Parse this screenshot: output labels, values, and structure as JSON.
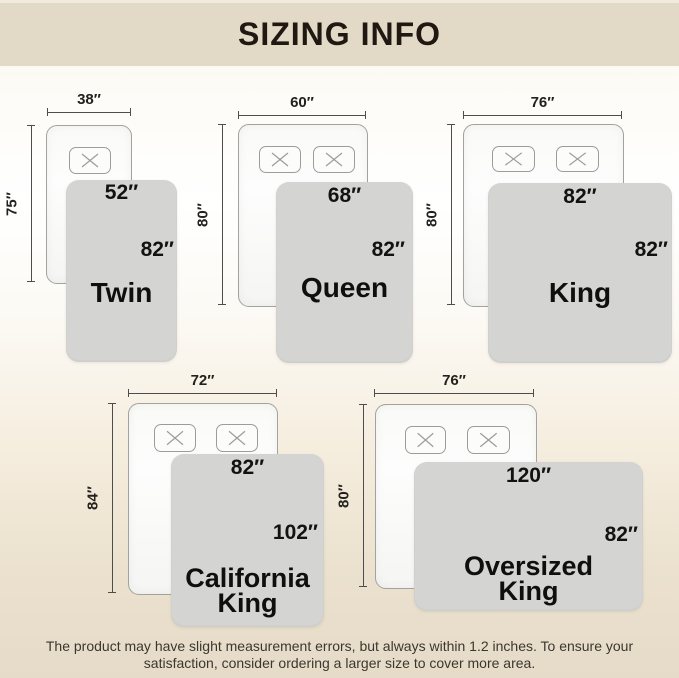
{
  "header": {
    "title": "SIZING INFO"
  },
  "diagrams": [
    {
      "name": "Twin",
      "bed_width": "38″",
      "bed_length": "75″",
      "blanket_width": "52″",
      "blanket_length": "82″",
      "pillow_count": 1
    },
    {
      "name": "Queen",
      "bed_width": "60″",
      "bed_length": "80″",
      "blanket_width": "68″",
      "blanket_length": "82″",
      "pillow_count": 2
    },
    {
      "name": "King",
      "bed_width": "76″",
      "bed_length": "80″",
      "blanket_width": "82″",
      "blanket_length": "82″",
      "pillow_count": 2
    },
    {
      "name": "California King",
      "bed_width": "72″",
      "bed_length": "84″",
      "blanket_width": "82″",
      "blanket_length": "102″",
      "pillow_count": 2
    },
    {
      "name": "Oversized King",
      "bed_width": "76″",
      "bed_length": "80″",
      "blanket_width": "120″",
      "blanket_length": "82″",
      "pillow_count": 2
    }
  ],
  "footer": {
    "line1": "The product may have slight measurement errors, but always within 1.2 inches. To ensure your",
    "line2": "satisfaction, consider ordering a larger size to cover more area."
  },
  "colors": {
    "banner": "#e3d9c7",
    "blanket": "#d4d4d3",
    "bed_border": "#a2a29e",
    "dimension_line": "#4d4d4d",
    "text": "#121212"
  }
}
